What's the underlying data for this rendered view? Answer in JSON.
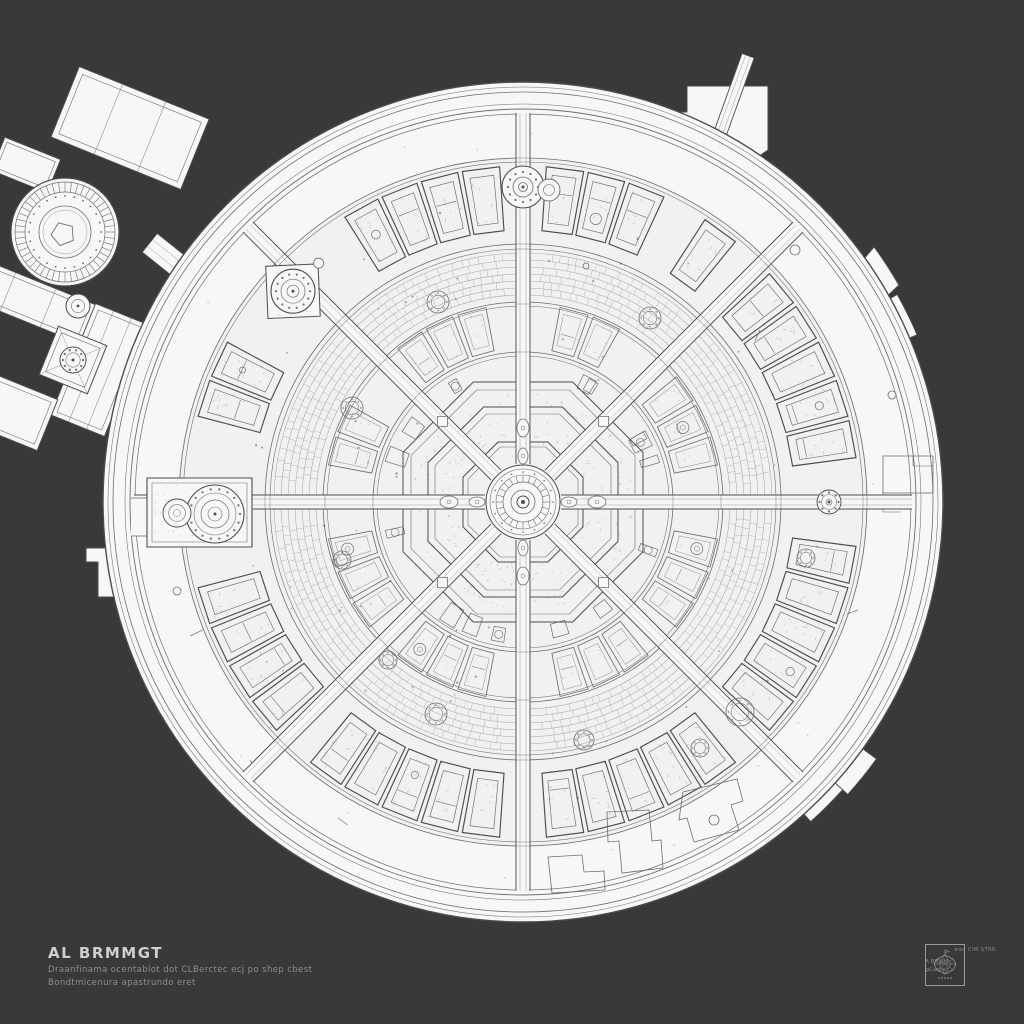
{
  "title_block": {
    "title": "AL BRMMGT",
    "subtitle_line1": "Draanfinama ocentablot dot CLBerctec ecj po shep cbest",
    "subtitle_line2": "Bondtmicenura apastrundo eret"
  },
  "stamp": {
    "side_text_line1": "A BRSIM",
    "side_text_line2": "gCarvali",
    "caption": "wwr CIM STRR",
    "emblem": "faceted-gem-drawing"
  },
  "drawing": {
    "seed": 7,
    "background": "#3a3938",
    "paper": "#f7f7f5",
    "paper_shade": "#f1f1ef",
    "ink": "#6e6e6e",
    "ink_dark": "#4d4d4d",
    "ink_light": "#9b9b9b",
    "main": {
      "cx": 523,
      "cy": 502,
      "r": 420,
      "rim_arcs": [
        [
          415,
          0.55
        ],
        [
          410,
          0.8
        ],
        [
          398,
          0.55
        ],
        [
          393,
          0.9
        ],
        [
          388,
          0.7
        ]
      ],
      "promenade_fill_r": 344,
      "promenade_arcs": [
        [
          344,
          0.85
        ],
        [
          340,
          0.6
        ]
      ],
      "corridor_ring_arcs": [
        [
          258,
          0.8
        ],
        [
          253,
          0.6
        ]
      ],
      "inner_arcs": [
        [
          200,
          0.8
        ],
        [
          196,
          0.55
        ],
        [
          150,
          0.8
        ],
        [
          146,
          0.55
        ]
      ],
      "outer_cells": {
        "r0": 272,
        "r1": 336,
        "step": 7.2
      },
      "inner_cells": {
        "r0": 154,
        "r1": 198,
        "step": 10
      },
      "texture_band": {
        "r0": 207,
        "r1": 249,
        "rows": 6
      },
      "room_band": {
        "r0": 122,
        "r1": 144,
        "count": 22
      },
      "radials": [
        0,
        45,
        90,
        135,
        180,
        225,
        270,
        315
      ],
      "corridor": {
        "half": 7,
        "r0": 38,
        "r1": 389
      },
      "skip": [
        [
          180,
          12
        ],
        [
          135,
          10
        ],
        [
          90,
          7
        ],
        [
          58,
          4
        ],
        [
          147,
          4
        ]
      ]
    },
    "center": {
      "octagons": [
        [
          55,
          60
        ],
        [
          88,
          95
        ],
        [
          112,
          120
        ]
      ],
      "texture": [
        [
          63,
          85
        ],
        [
          97,
          110
        ]
      ],
      "ellipses": [
        [
          46,
          5,
          8
        ],
        [
          74,
          6,
          9
        ]
      ],
      "rings": [
        [
          37,
          1.0
        ],
        [
          33,
          0.6
        ],
        [
          27,
          0.6
        ],
        [
          20,
          0.7
        ],
        [
          12,
          0.8
        ]
      ],
      "core": 6,
      "squares_r": 114,
      "square_size": 10
    },
    "nodes": {
      "north": {
        "a": 90,
        "r": 315,
        "outer": 21
      },
      "north_small": {
        "x": 549,
        "y": 190,
        "r": 11
      },
      "nw": {
        "a": 137.5,
        "r": 312,
        "outer": 22,
        "diamond": 37
      },
      "east_small": {
        "a": 0,
        "r": 306,
        "r1": 12
      },
      "chapel": {
        "x0": 147,
        "y0": 478,
        "x1": 252,
        "y1": 547,
        "rosette": [
          215,
          514,
          29
        ],
        "small": [
          177,
          513,
          14
        ]
      },
      "inner_rosettes": [
        [
          740,
          712,
          14
        ],
        [
          700,
          748,
          9
        ],
        [
          436,
          714,
          11
        ],
        [
          388,
          660,
          9
        ],
        [
          352,
          408,
          11
        ],
        [
          438,
          302,
          11
        ],
        [
          650,
          318,
          11
        ],
        [
          806,
          558,
          9
        ],
        [
          584,
          740,
          10
        ],
        [
          342,
          560,
          9
        ]
      ]
    },
    "promenade": {
      "rooms": [
        [
          [
            607,
            812
          ],
          [
            649,
            810
          ],
          [
            652,
            841
          ],
          [
            661,
            840
          ],
          [
            663,
            868
          ],
          [
            622,
            873
          ],
          [
            619,
            841
          ],
          [
            608,
            842
          ]
        ],
        [
          [
            548,
            857
          ],
          [
            582,
            855
          ],
          [
            584,
            872
          ],
          [
            604,
            871
          ],
          [
            605,
            890
          ],
          [
            552,
            893
          ]
        ],
        [
          [
            683,
            792
          ],
          [
            737,
            779
          ],
          [
            743,
            801
          ],
          [
            731,
            805
          ],
          [
            739,
            830
          ],
          [
            694,
            842
          ],
          [
            687,
            818
          ],
          [
            679,
            820
          ]
        ],
        [
          [
            883,
            456
          ],
          [
            933,
            456
          ],
          [
            933,
            493
          ],
          [
            883,
            493
          ]
        ]
      ],
      "room_polylines": [
        [
          [
            913,
            456
          ],
          [
            913,
            466
          ],
          [
            933,
            466
          ]
        ],
        [
          [
            883,
            493
          ],
          [
            883,
            512
          ],
          [
            901,
            512
          ]
        ]
      ],
      "circles": [
        [
          795,
          250,
          5
        ],
        [
          892,
          395,
          4
        ],
        [
          714,
          820,
          5
        ],
        [
          177,
          591,
          4
        ],
        [
          586,
          266,
          3
        ]
      ],
      "ticks": [
        [
          190,
          636,
          14,
          -25
        ],
        [
          338,
          818,
          12,
          35
        ],
        [
          760,
          330,
          12,
          115
        ],
        [
          858,
          610,
          12,
          160
        ],
        [
          250,
          760,
          12,
          60
        ]
      ]
    },
    "protrusions": {
      "top": [
        [
          662,
          168
        ],
        [
          662,
          112
        ],
        [
          687,
          112
        ],
        [
          687,
          86
        ],
        [
          768,
          86
        ],
        [
          768,
          150
        ],
        [
          742,
          168
        ]
      ],
      "left": [
        [
          140,
          548
        ],
        [
          86,
          548
        ],
        [
          86,
          562
        ],
        [
          98,
          562
        ],
        [
          98,
          597
        ],
        [
          140,
          597
        ]
      ],
      "arc_bands": [
        {
          "a0": 36,
          "a1": 29,
          "r": 434
        },
        {
          "a0": 29,
          "a1": 23,
          "r": 428
        },
        {
          "a0": -36,
          "a1": -42,
          "r": 437
        },
        {
          "a0": -42,
          "a1": -48,
          "r": 430
        }
      ]
    },
    "north_corridor": {
      "x1": 748,
      "y1": 56,
      "x2": 676,
      "y2": 256,
      "w": 13
    },
    "annex": {
      "rects": [
        {
          "cx": 130,
          "cy": 128,
          "w": 140,
          "h": 76,
          "a": 22,
          "inset": 6,
          "div": 2
        },
        {
          "cx": 26,
          "cy": 165,
          "w": 60,
          "h": 36,
          "a": 22,
          "inset": 4,
          "div": 0
        },
        {
          "cx": 28,
          "cy": 300,
          "w": 130,
          "h": 42,
          "a": 22,
          "inset": 5,
          "div": 2
        },
        {
          "cx": 100,
          "cy": 370,
          "w": 58,
          "h": 120,
          "a": 22,
          "inset": 5,
          "div": 2
        },
        {
          "cx": 15,
          "cy": 412,
          "w": 70,
          "h": 55,
          "a": 22,
          "inset": 5,
          "div": 0
        },
        {
          "cx": 73,
          "cy": 360,
          "w": 52,
          "h": 52,
          "a": 22,
          "inset": 5,
          "div": 0
        }
      ],
      "corridor": {
        "x1": 150,
        "y1": 243,
        "x2": 264,
        "y2": 334,
        "w": 24
      },
      "rotunda": {
        "x": 65,
        "y": 232,
        "outer": 54
      },
      "node": {
        "x": 78,
        "y": 306,
        "r": 12
      },
      "pavilion_rosette": [
        73,
        360,
        13
      ]
    }
  }
}
